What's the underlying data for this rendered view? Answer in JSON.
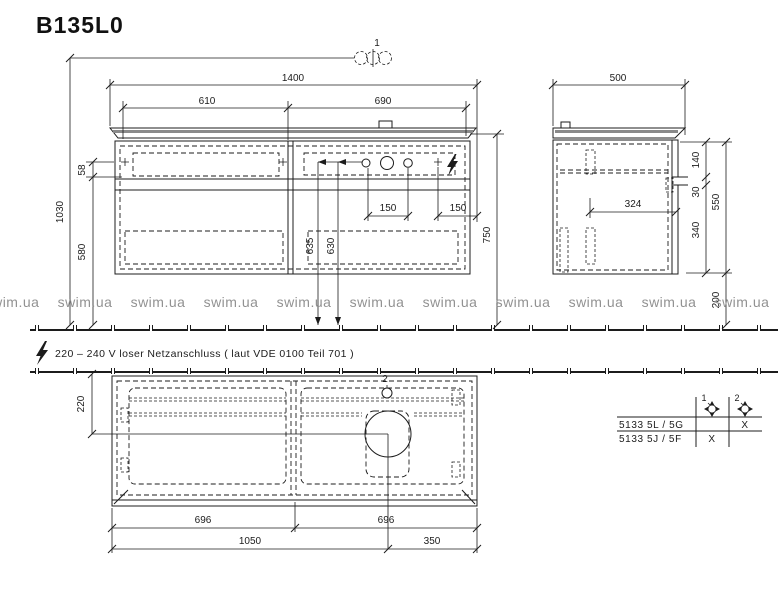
{
  "title": "B135L0",
  "watermark": {
    "text": "swim.ua"
  },
  "note": {
    "text": "220 – 240 V loser Netzanschluss ( laut VDE 0100 Teil 701 )"
  },
  "callouts": {
    "tap_holes": "1",
    "basin_hole": "2"
  },
  "front": {
    "dims": {
      "total_width": "1400",
      "left_width": "610",
      "right_width": "690",
      "tap_height": "1030",
      "tap_offset": "58",
      "body_height": "580",
      "hole_pitch_left": "150",
      "hole_pitch_right": "150",
      "drain_height_left": "635",
      "drain_height_right": "630",
      "top_height": "750"
    }
  },
  "side": {
    "dims": {
      "depth": "500",
      "top_inset": "140",
      "notch": "30",
      "rail_span": "340",
      "height": "550",
      "inner_depth": "324",
      "floor_gap": "200"
    }
  },
  "plan": {
    "dims": {
      "wall_offset": "220",
      "left_half": "696",
      "right_half": "696",
      "drain_x": "1050",
      "drain_right": "350"
    }
  },
  "table": {
    "columns": [
      {
        "num": "1"
      },
      {
        "num": "2"
      }
    ],
    "rows": [
      {
        "label": "5133 5L / 5G",
        "hole1": "",
        "hole2": "X"
      },
      {
        "label": "5133 5J / 5F",
        "hole1": "X",
        "hole2": ""
      }
    ]
  }
}
